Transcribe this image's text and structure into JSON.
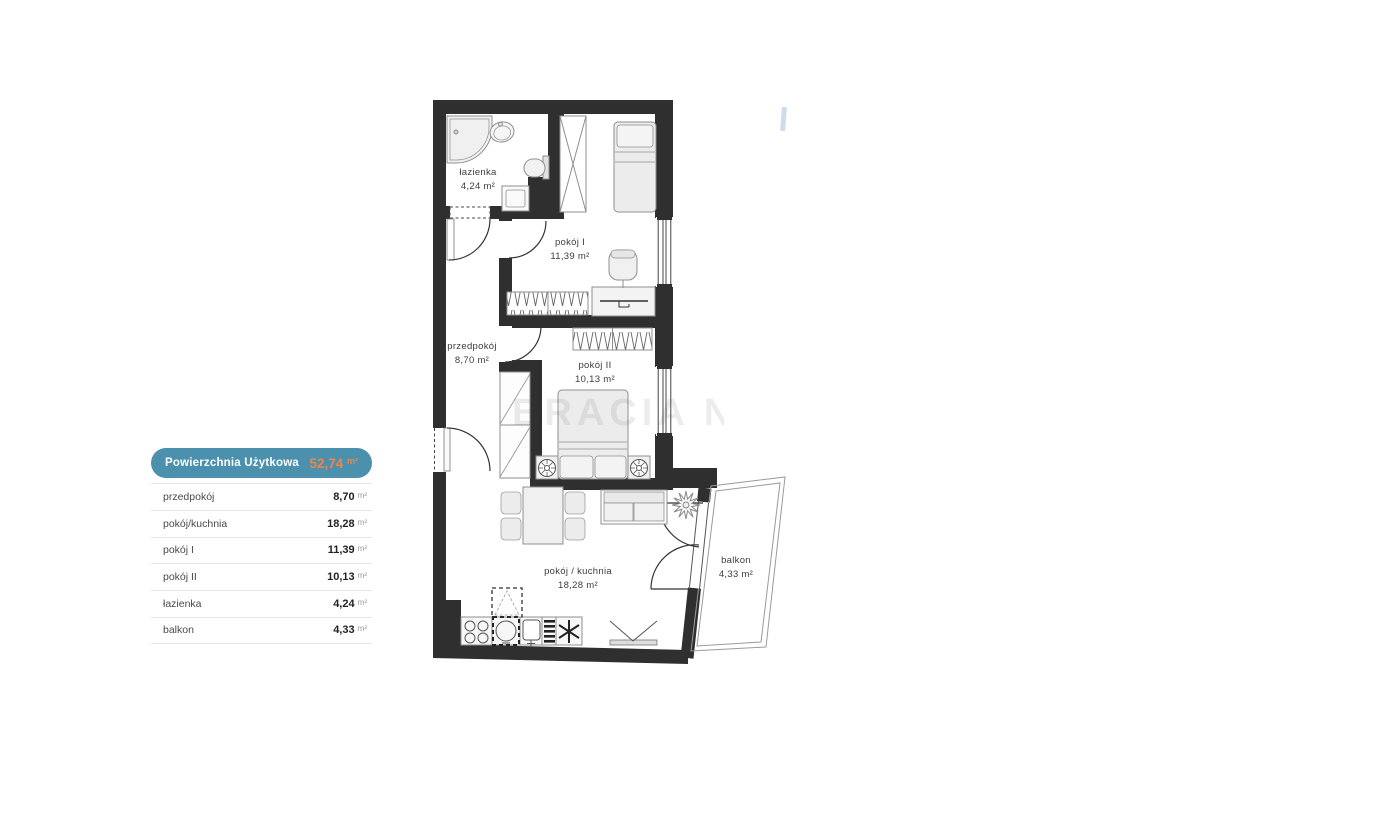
{
  "legend": {
    "title": "Powierzchnia Użytkowa",
    "total": "52,74",
    "total_unit": "m²",
    "rows": [
      {
        "label": "przedpokój",
        "value": "8,70",
        "unit": "m²"
      },
      {
        "label": "pokój/kuchnia",
        "value": "18,28",
        "unit": "m²"
      },
      {
        "label": "pokój I",
        "value": "11,39",
        "unit": "m²"
      },
      {
        "label": "pokój II",
        "value": "10,13",
        "unit": "m²"
      },
      {
        "label": "łazienka",
        "value": "4,24",
        "unit": "m²"
      },
      {
        "label": "balkon",
        "value": "4,33",
        "unit": "m²"
      }
    ],
    "colors": {
      "header_bg": "#4b90ad",
      "header_text": "#ffffff",
      "total_color": "#ee8549"
    }
  },
  "plan": {
    "watermark": "BRACIA N",
    "rooms": [
      {
        "name": "łazienka",
        "area": "4,24 m²"
      },
      {
        "name": "pokój I",
        "area": "11,39 m²"
      },
      {
        "name": "przedpokój",
        "area": "8,70 m²"
      },
      {
        "name": "pokój II",
        "area": "10,13 m²"
      },
      {
        "name": "pokój / kuchnia",
        "area": "18,28 m²"
      },
      {
        "name": "balkon",
        "area": "4,33 m²"
      }
    ],
    "colors": {
      "wall": "#2f2f2f",
      "furniture_fill": "#efefef",
      "furniture_stroke": "#8f8f8f",
      "label_text": "#3d3d3d"
    }
  }
}
